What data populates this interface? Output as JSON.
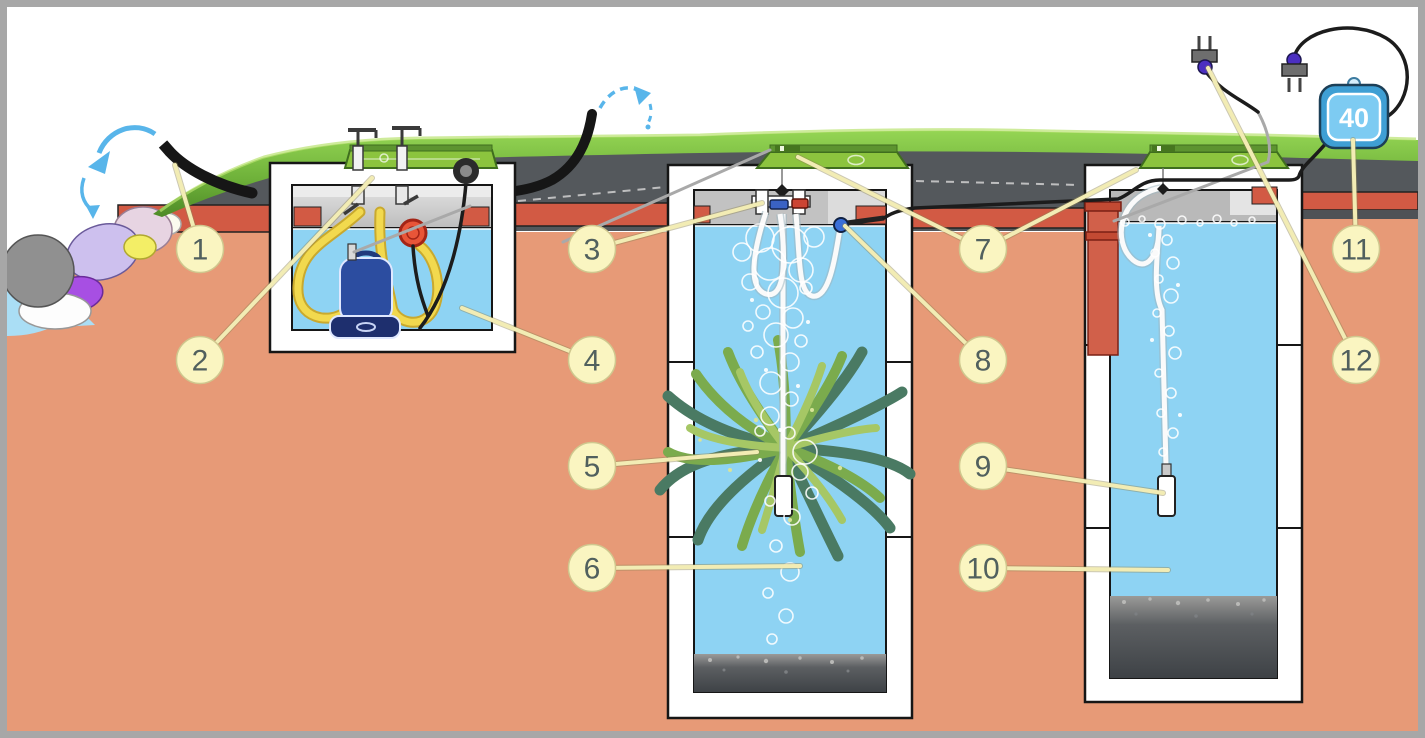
{
  "diagram": {
    "air_pump": {
      "label": "40"
    },
    "callouts": [
      {
        "number": "1"
      },
      {
        "number": "2"
      },
      {
        "number": "3"
      },
      {
        "number": "4"
      },
      {
        "number": "5"
      },
      {
        "number": "6"
      },
      {
        "number": "7"
      },
      {
        "number": "8"
      },
      {
        "number": "9"
      },
      {
        "number": "10"
      },
      {
        "number": "11"
      },
      {
        "number": "12"
      }
    ],
    "colors": {
      "soil": "#e79a77",
      "brick": "#d25a44",
      "asphalt": "#54585c",
      "grass": "#7ab93e",
      "lid_green": "#8cc43e",
      "water": "#8ed3f3",
      "callout_fill": "#faf5c1",
      "leader": "#f2ecb4",
      "pump_body": "#2c4da0",
      "hose_yellow": "#f2d94e",
      "arrow_blue": "#58b5ea",
      "air_pump_fill": "#7dcbf2",
      "sludge": "#3e4246"
    },
    "icons": [
      "curved-flow-arrow",
      "ac-plug",
      "air-pump-box",
      "submersible-pump",
      "float-switch",
      "air-diffuser",
      "filter-plant",
      "cable-grommet"
    ]
  }
}
